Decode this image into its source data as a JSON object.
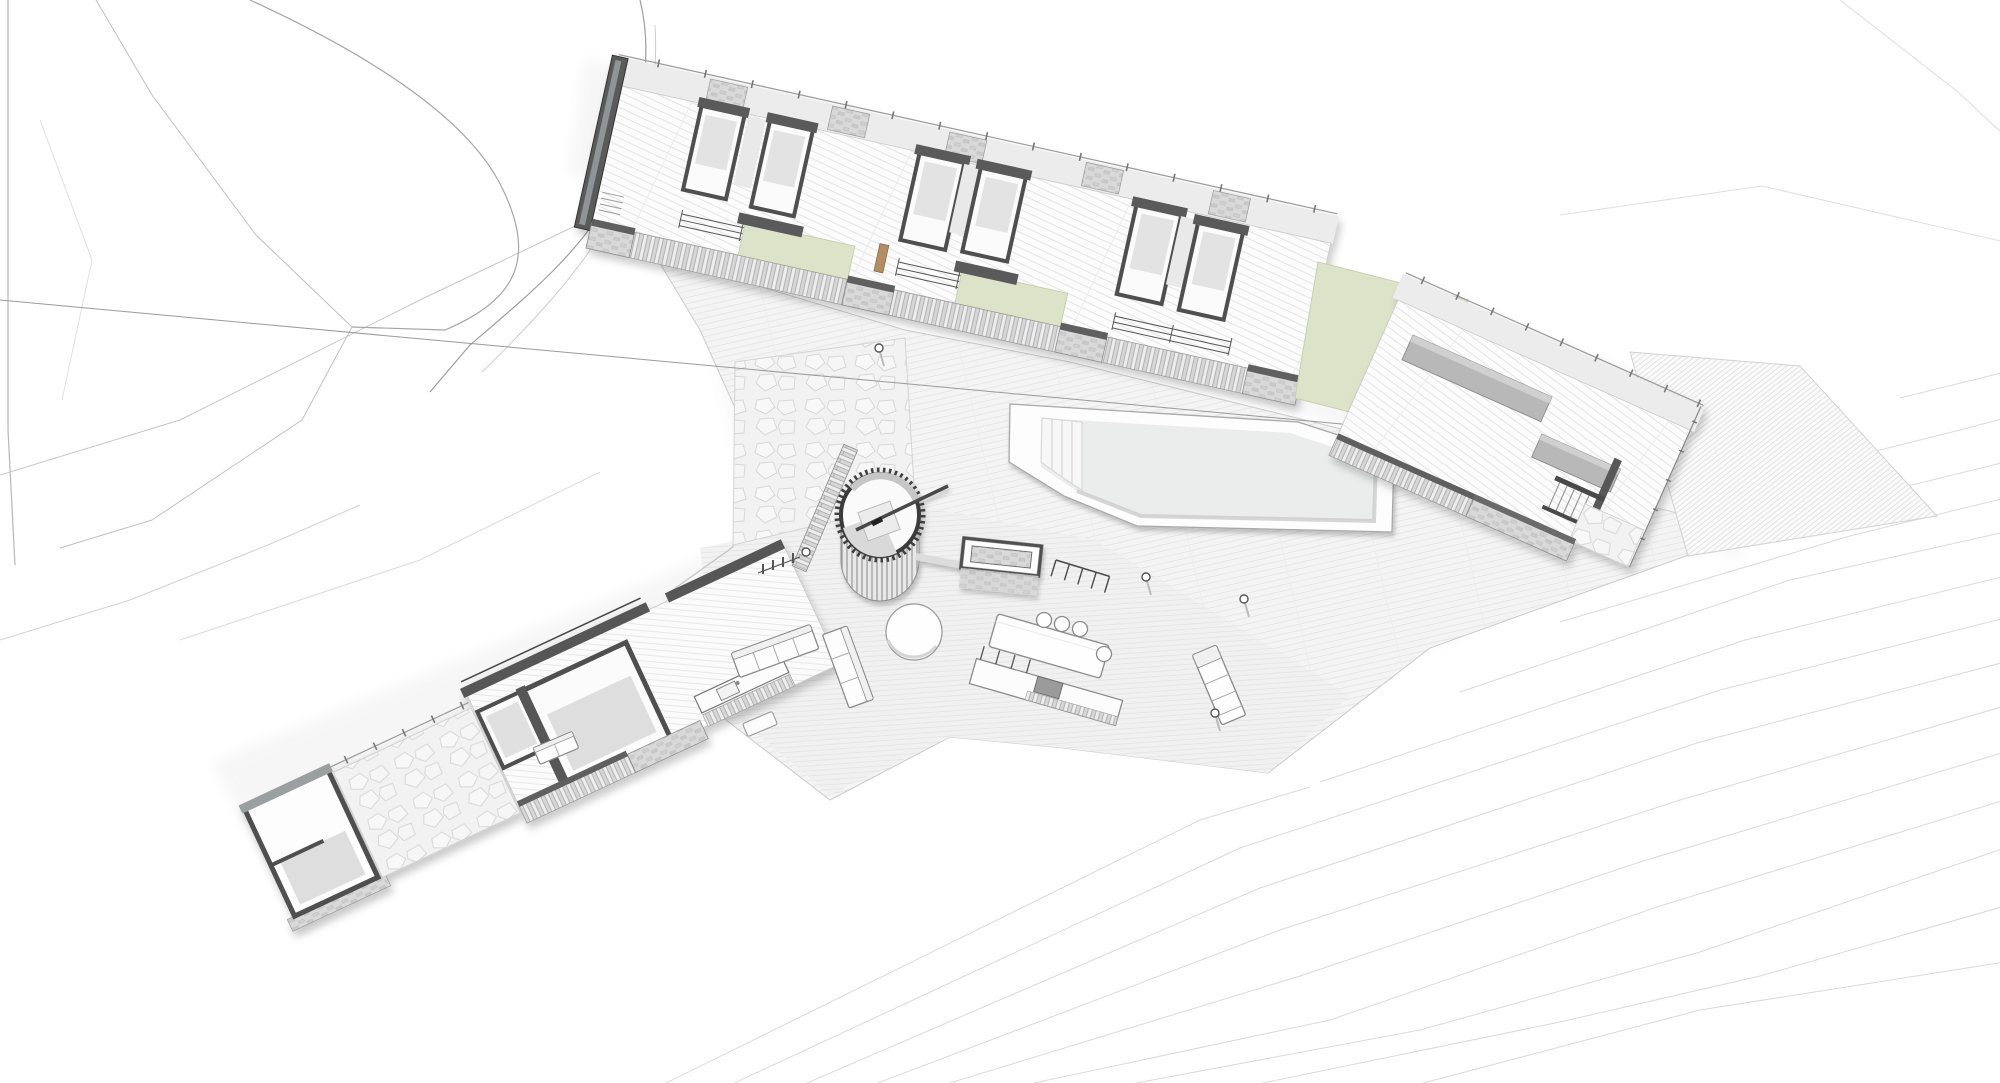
{
  "scene": {
    "kind": "architectural axonometric site plan",
    "features": [
      "site-contour-lines",
      "bedroom-wing",
      "planted-courtyards",
      "swimming-pool",
      "pool-terrace",
      "spiral-staircase",
      "outdoor-fireplace",
      "living-wing",
      "stone-courtyard",
      "garage-room",
      "dining-table",
      "outdoor-kitchen",
      "sofas",
      "coffee-table",
      "chaise-lounge",
      "timber-deck",
      "louvred-screens",
      "perimeter-fence",
      "bollard-lights"
    ]
  },
  "palette": {
    "background": "#ffffff",
    "contour": "#d9d9d9",
    "contour_dark": "#a3a3a3",
    "wall_dark": "#555555",
    "wall_mid": "#9aa0a0",
    "wall_light": "#c9c9c9",
    "floor_gray": "#dedede",
    "paving": "#f3f3f3",
    "paving_line": "#e4e4e4",
    "green": "#dde3c9",
    "green_edge": "#c6d2aa",
    "pool_water": "#ebecec",
    "pool_shadow": "#cccccc",
    "furniture_stroke": "#8a8a8a",
    "accent_tan": "#b48e62",
    "block_gray": "#b8b8b8"
  }
}
